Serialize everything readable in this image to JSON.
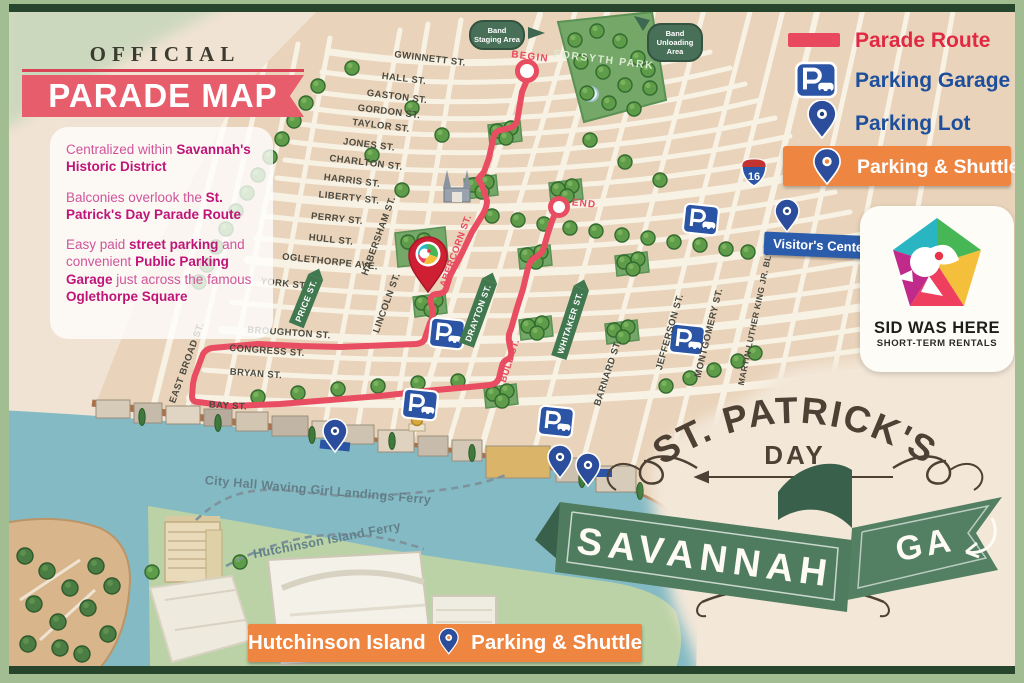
{
  "header": {
    "official": "OFFICIAL",
    "title": "PARADE MAP"
  },
  "panel": {
    "p1a": "Centralized within ",
    "p1b": "Savannah's Historic District",
    "p2a": "Balconies overlook the ",
    "p2b": "St. Patrick's Day Parade Route",
    "p3a": "Easy paid ",
    "p3b": "street parking",
    "p3c": " and convenient ",
    "p3d": "Public Parking Garage",
    "p3e": " just across the famous ",
    "p3f": "Oglethorpe Square"
  },
  "legend": {
    "parade_route": "Parade Route",
    "parking_garage": "Parking Garage",
    "parking_lot": "Parking Lot",
    "parking_shuttle": "Parking & Shuttle"
  },
  "map": {
    "streets": {
      "gwinnett": "GWINNETT ST.",
      "hall": "HALL ST.",
      "gaston": "GASTON ST.",
      "gordon": "GORDON ST.",
      "taylor": "TAYLOR ST.",
      "jones": "JONES ST.",
      "charlton": "CHARLTON ST.",
      "harris": "HARRIS ST.",
      "liberty": "LIBERTY ST.",
      "perry": "PERRY ST.",
      "hull": "HULL ST.",
      "oglethorpe": "OGLETHORPE AVE.",
      "york": "YORK ST.",
      "broughton": "BROUGHTON ST.",
      "congress": "CONGRESS ST.",
      "bryan": "BRYAN ST.",
      "bay": "BAY ST.",
      "east_broad": "EAST BROAD ST.",
      "price": "PRICE ST.",
      "habersham": "HABERSHAM ST.",
      "lincoln": "LINCOLN ST.",
      "abercorn": "ABERCORN ST.",
      "drayton": "DRAYTON ST.",
      "bull": "BULL ST.",
      "whitaker": "WHITAKER ST.",
      "barnard": "BARNARD ST.",
      "jefferson": "JEFFERSON ST.",
      "montgomery": "MONTGOMERY ST.",
      "mlk": "MARTIN LUTHER KING JR. BLVD."
    },
    "markers": {
      "begin": "BEGIN",
      "end": "END",
      "forsyth": "FORSYTH PARK",
      "band_staging": "Band Staging Area",
      "band_unloading": "Band Unloading Area",
      "visitor_center": "Visitor's Center",
      "i16": "16"
    },
    "ferries": {
      "city_hall": "City Hall Waving Girl Landings Ferry",
      "hutchinson": "Hutchinson Island Ferry"
    }
  },
  "island_banner": {
    "name": "Hutchinson Island",
    "shuttle": "Parking & Shuttle"
  },
  "sid": {
    "line1": "SID WAS HERE",
    "line2": "SHORT-TERM RENTALS"
  },
  "title_art": {
    "arc": "ST. PATRICK'S",
    "day": "DAY",
    "savannah": "SAVANNAH",
    "ga": "GA"
  },
  "colors": {
    "route": "#e8495f",
    "legend_blue": "#1d4f9c",
    "orange": "#ee8540",
    "dark_green": "#3f6852",
    "ribbon_green": "#4f7c5e"
  }
}
